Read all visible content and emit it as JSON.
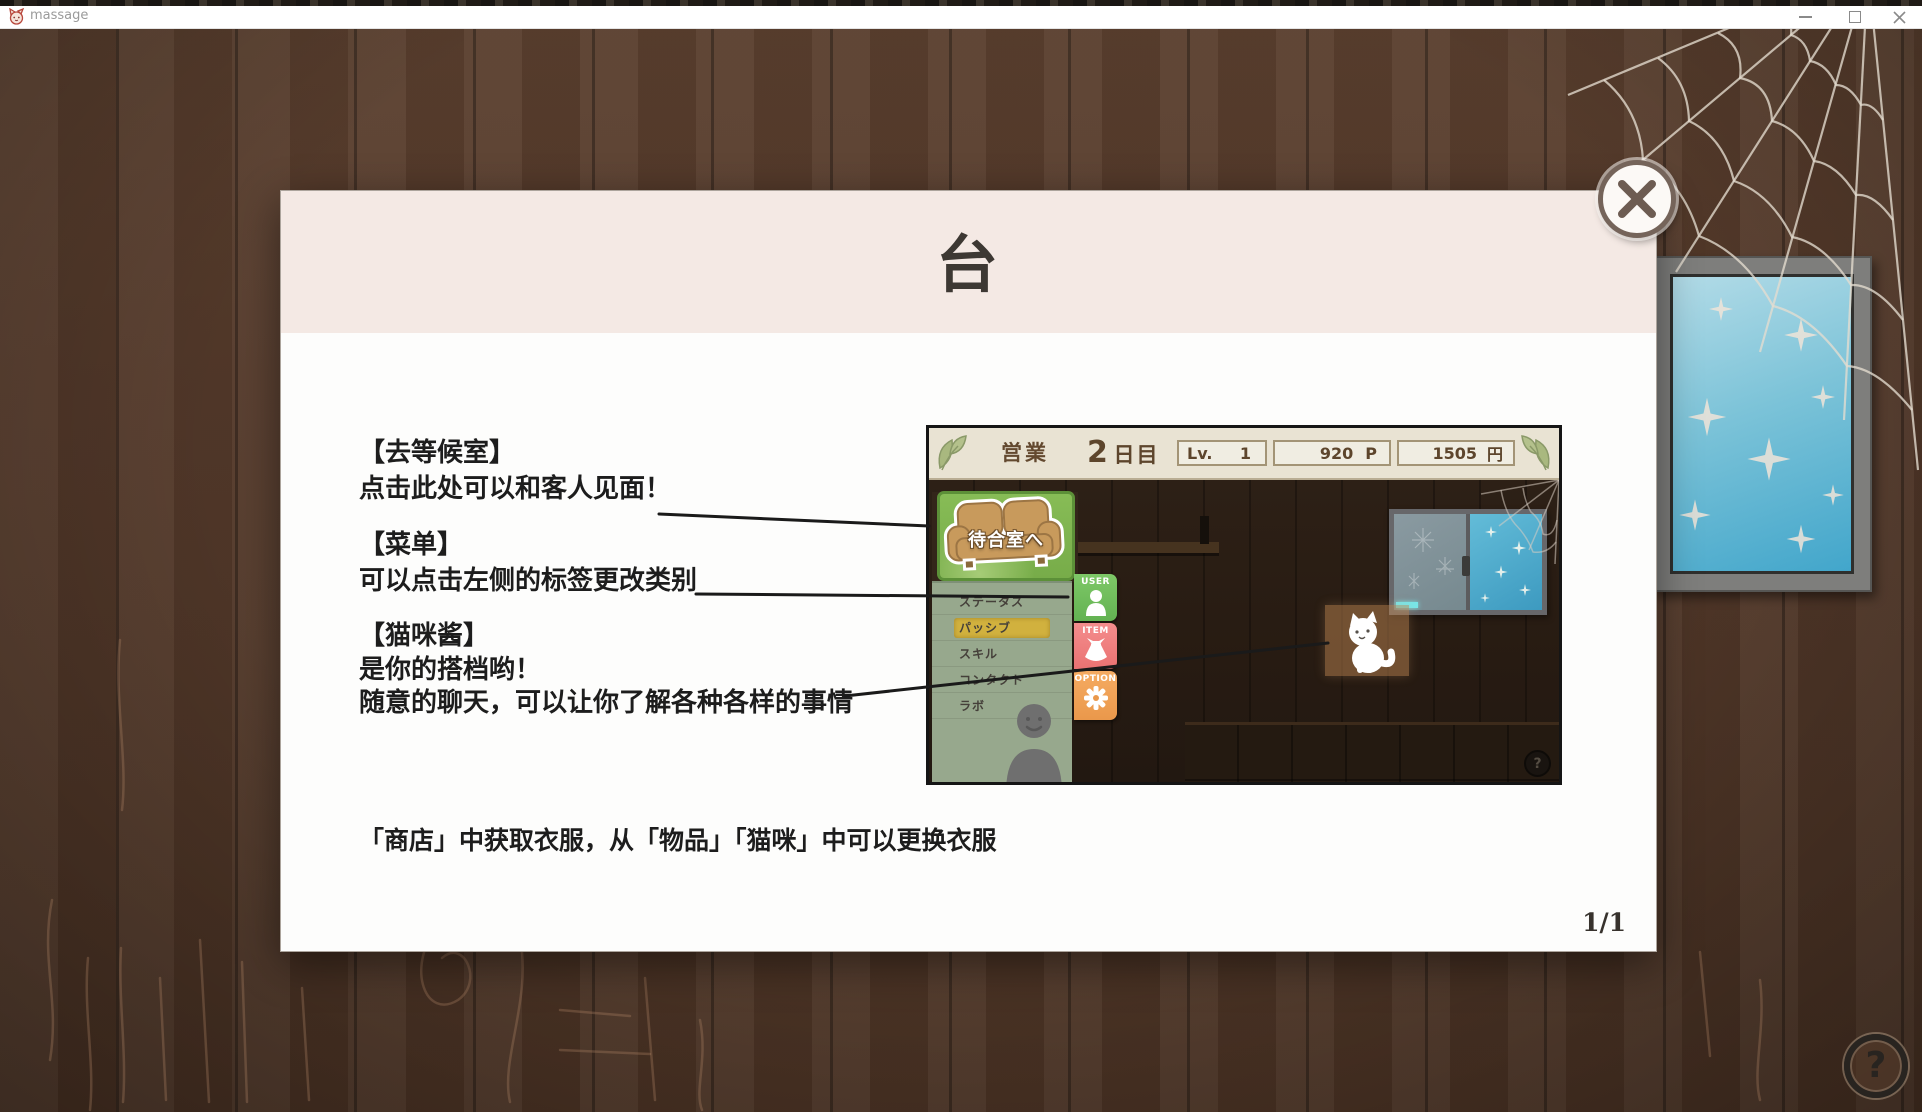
{
  "window": {
    "title": "massage"
  },
  "dialog": {
    "title": "台",
    "page_indicator": "1/1",
    "sections": [
      {
        "heading": "【去等候室】",
        "lines": [
          "点击此处可以和客人见面！"
        ]
      },
      {
        "heading": "【菜单】",
        "lines": [
          "可以点击左侧的标签更改类别"
        ]
      },
      {
        "heading": "【猫咪酱】",
        "lines": [
          "是你的搭档哟！",
          "随意的聊天，可以让你了解各种各样的事情"
        ]
      }
    ],
    "footer_note": "「商店」中获取衣服，从「物品」「猫咪」中可以更换衣服"
  },
  "mini": {
    "header": {
      "mode": "営業",
      "day_value": "2",
      "day_unit": "日目",
      "level_label": "Lv.",
      "level_value": "1",
      "points_value": "920",
      "points_unit": "P",
      "money_value": "1505",
      "money_unit": "円"
    },
    "waiting_room_button": "待合室へ",
    "menu_tabs": [
      {
        "label": "ステータス",
        "active": false
      },
      {
        "label": "パッシブ",
        "active": true
      },
      {
        "label": "スキル",
        "active": false
      },
      {
        "label": "コンタクト",
        "active": false
      },
      {
        "label": "ラボ",
        "active": false
      }
    ],
    "side_buttons": [
      {
        "label": "USER",
        "color": "#74c266"
      },
      {
        "label": "ITEM",
        "color": "#ef8080"
      },
      {
        "label": "OPTION",
        "color": "#f2a359"
      }
    ],
    "help_glyph": "?"
  },
  "help_button": {
    "glyph": "?"
  },
  "colors": {
    "dialog_header": "#f4e9e4",
    "active_tab": "#d1b13e",
    "waiting_button_green": "#7fb34e",
    "user_button": "#74c266",
    "item_button": "#ef8080",
    "option_button": "#f2a359",
    "wood_base": "#53392a",
    "frame_glass": "#6cc0da"
  }
}
